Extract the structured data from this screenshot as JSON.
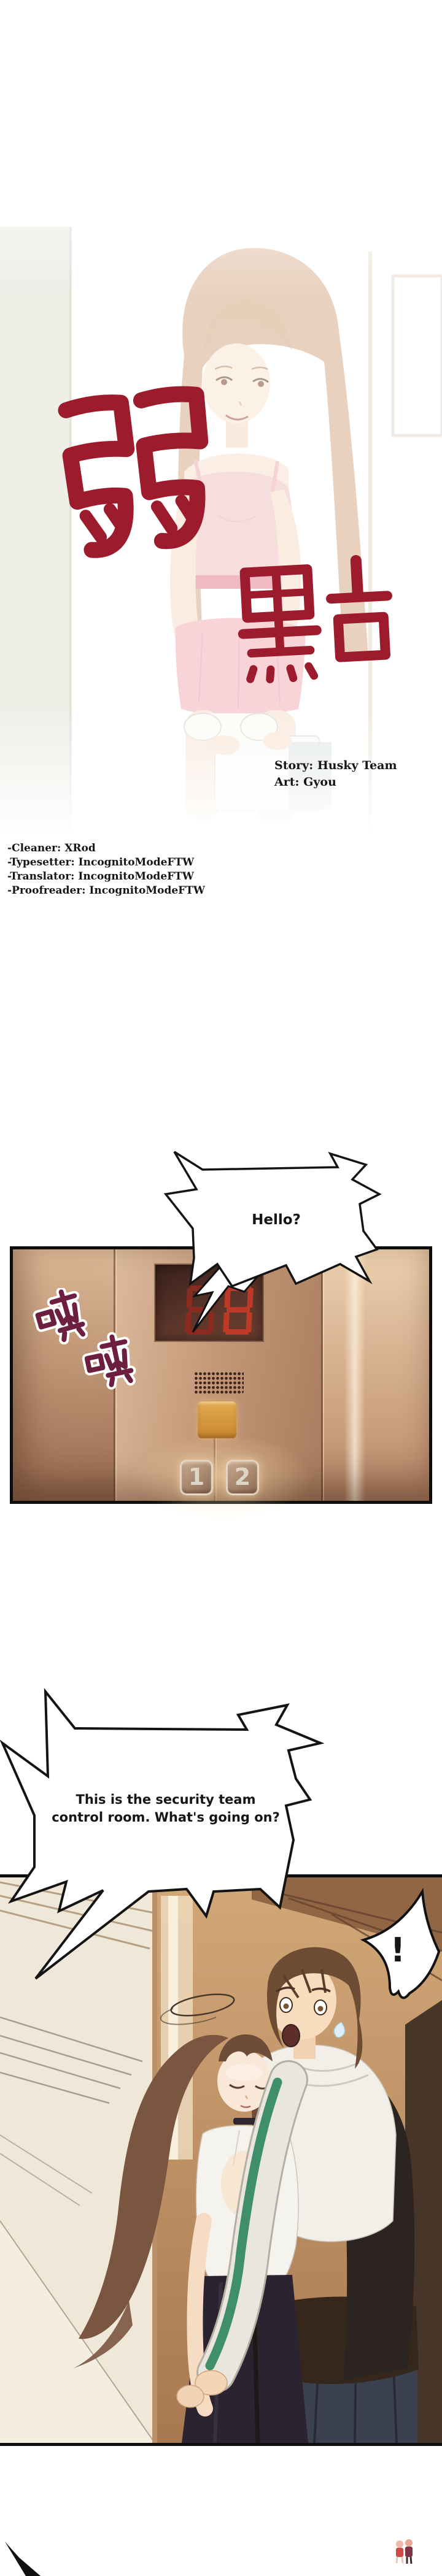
{
  "cover": {
    "title_char_1": "弱",
    "title_char_2": "點",
    "story_credit": "Story: Husky Team",
    "art_credit": "Art: Gyou",
    "title_red": "#9c1b2c"
  },
  "staff_credits": {
    "lines": [
      "-Cleaner: XRod",
      "-Typesetter: IncognitoModeFTW",
      "-Translator: IncognitoModeFTW",
      "-Proofreader: IncognitoModeFTW"
    ]
  },
  "speech_bubbles": {
    "hello": {
      "text": "Hello?"
    },
    "control_room": {
      "line1": "This is the security team",
      "line2": "control room. What's going on?"
    },
    "exclamation": {
      "text": "!"
    }
  },
  "elevator": {
    "sfx_char_1": "嗤",
    "sfx_char_2": "嗤",
    "floor_display_digits": "88",
    "button_1_label": "1",
    "button_2_label": "2",
    "wall_color": "#c59d82",
    "call_button_color": "#d89b3f",
    "digit_red": "#b23527",
    "sfx_maroon": "#6d1f40"
  },
  "hallway": {
    "wall_color": "#c89a6f",
    "hoodie_stripe_green": "#3f8f6a"
  }
}
